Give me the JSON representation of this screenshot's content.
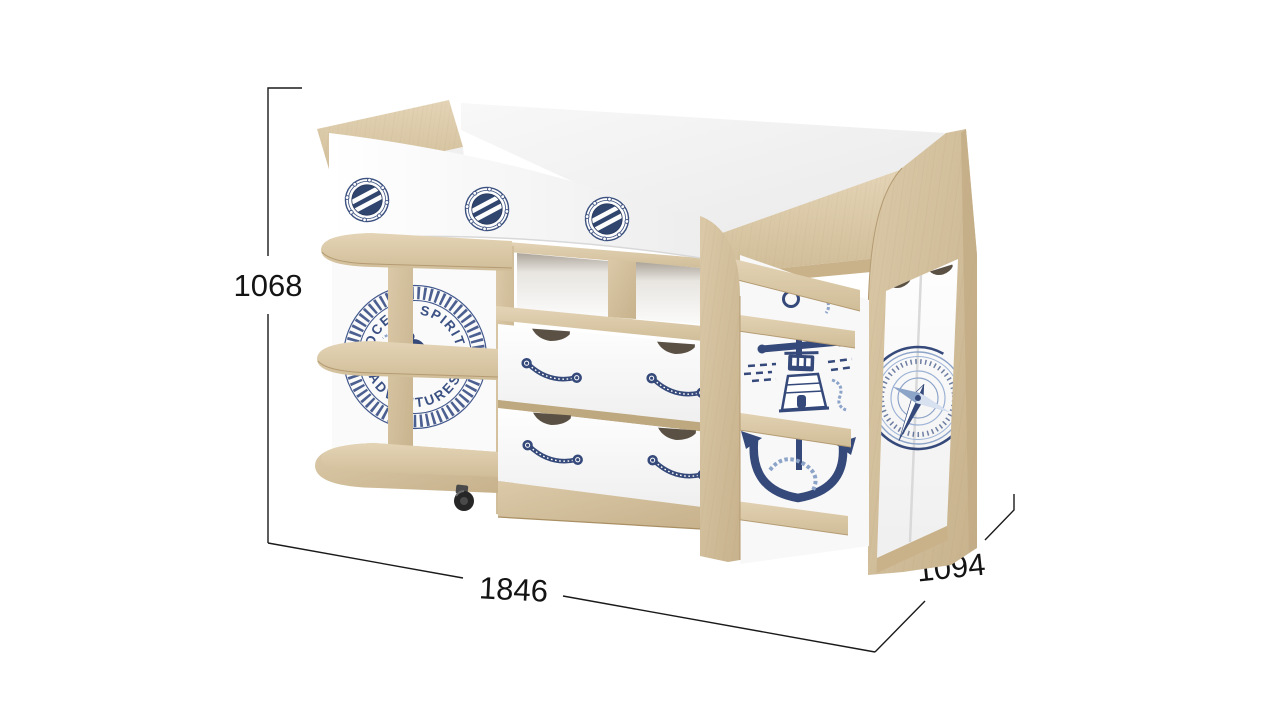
{
  "dimension_labels": {
    "height": "1068",
    "width": "1846",
    "depth": "1094"
  },
  "emblem_text": {
    "top": "OCEAN SPIRIT",
    "bottom": "ADVENTURES",
    "separator_left": "★",
    "separator_right": "★"
  },
  "colors": {
    "wood_light": "#e2d2b4",
    "wood_mid": "#d3c09c",
    "wood_dark": "#c2ab84",
    "navy": "#35497a",
    "steel_blue": "#8da4c9",
    "panel_white": "#fbfbfb",
    "dimension_line": "#1a1a1a",
    "cutout_dark": "#5a5043"
  },
  "icons": [
    "porthole-icon",
    "ship-bell-icon",
    "star-icon",
    "lighthouse-anchor-icon",
    "compass-rose-icon",
    "rope-handle-icon",
    "caster-wheel-icon"
  ]
}
